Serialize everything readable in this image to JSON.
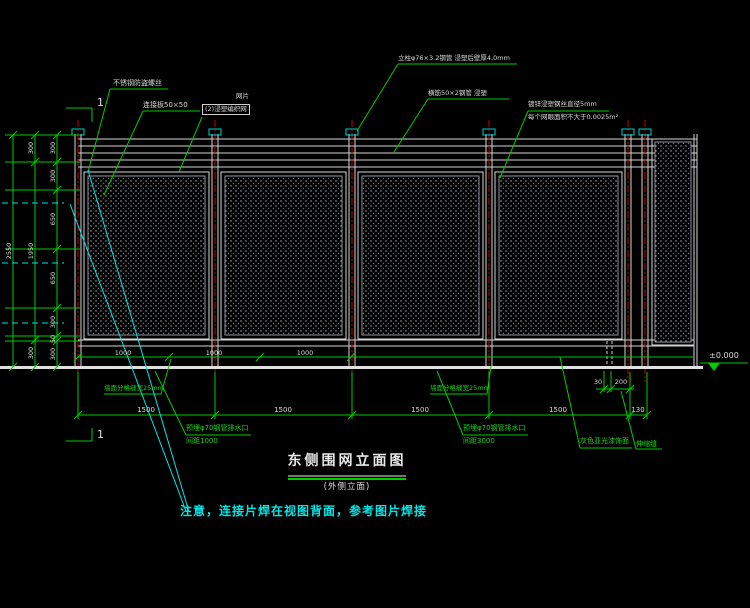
{
  "title": {
    "main": "东侧围网立面图",
    "sub": "(外侧立面)"
  },
  "note": "注意，连接片焊在视图背面，参考图片焊接",
  "level_mark": "±0.000",
  "section_label": "1",
  "callouts": {
    "anti_theft_screw": "不锈钢防盗螺丝",
    "connector_plate": "连接板50×50",
    "mesh_name": "网片",
    "mesh_spec": "(2)浸塑编织网",
    "post_spec": "立柱φ76×3.2钢管 浸塑后壁厚4.0mm",
    "rail_spec": "横筋50×2钢管 浸塑",
    "wire_spec_1": "镀锌浸塑钢丝直径5mm",
    "wire_spec_2": "每个网眼面积不大于0.0025m²",
    "wall_joint_left": "墙面分格缝宽25mm",
    "wall_joint_right": "墙面分格缝宽25mm",
    "drain_left_1": "预埋φ70钢管排水口",
    "drain_left_2": "间距1000",
    "drain_right_1": "预埋φ70钢管排水口",
    "drain_right_2": "间距3000",
    "paint": "灰色亚光漆饰面",
    "expansion_joint": "伸缩缝"
  },
  "dimensions": {
    "left_total": "2550",
    "left_mid": [
      "300",
      "1950",
      "300"
    ],
    "left_inner": [
      "300",
      "300",
      "650",
      "650",
      "300",
      "50",
      "300"
    ],
    "spacing_1000": [
      "1000",
      "1000",
      "1000"
    ],
    "bay_1500": [
      "1500",
      "1500",
      "1500",
      "1500"
    ],
    "joint_130": "130",
    "joint_30": "30",
    "joint_200": "200"
  },
  "colors": {
    "background": "#000000",
    "drawing_line": "#d4d4d4",
    "dimension_green": "#00cc00",
    "post_centerline_red": "#c00000",
    "cap_cyan": "#00cccc",
    "note_cyan": "#00e5e5"
  }
}
